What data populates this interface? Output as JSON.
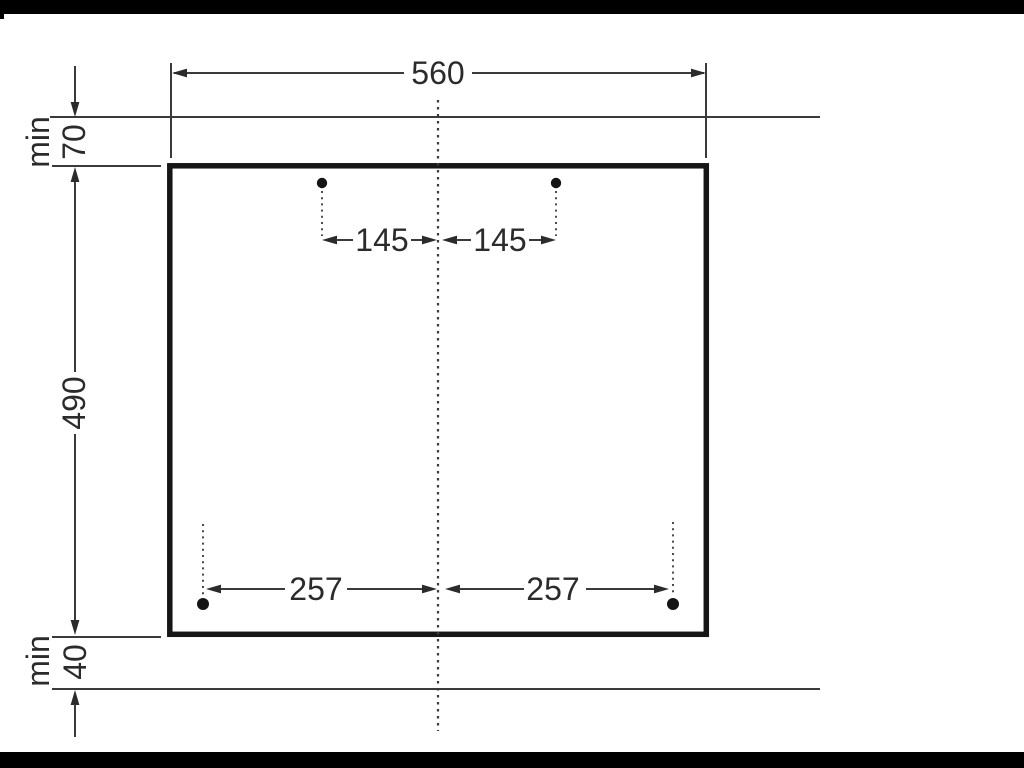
{
  "diagram": {
    "description": "appliance cutout installation dimension drawing",
    "cutout": {
      "width_label": "560",
      "height_label": "490"
    },
    "top_clearance": {
      "min_label": "min",
      "value": "70"
    },
    "bottom_clearance": {
      "min_label": "min",
      "value": "40"
    },
    "top_holes": {
      "left_offset": "145",
      "right_offset": "145"
    },
    "bottom_holes": {
      "left_offset": "257",
      "right_offset": "257"
    }
  },
  "colors": {
    "letterbox_bar": "#000000",
    "thin_line": "#3a3a3a",
    "cutout_outline": "#161616",
    "text": "#2b2b2b",
    "background": "#ffffff"
  }
}
